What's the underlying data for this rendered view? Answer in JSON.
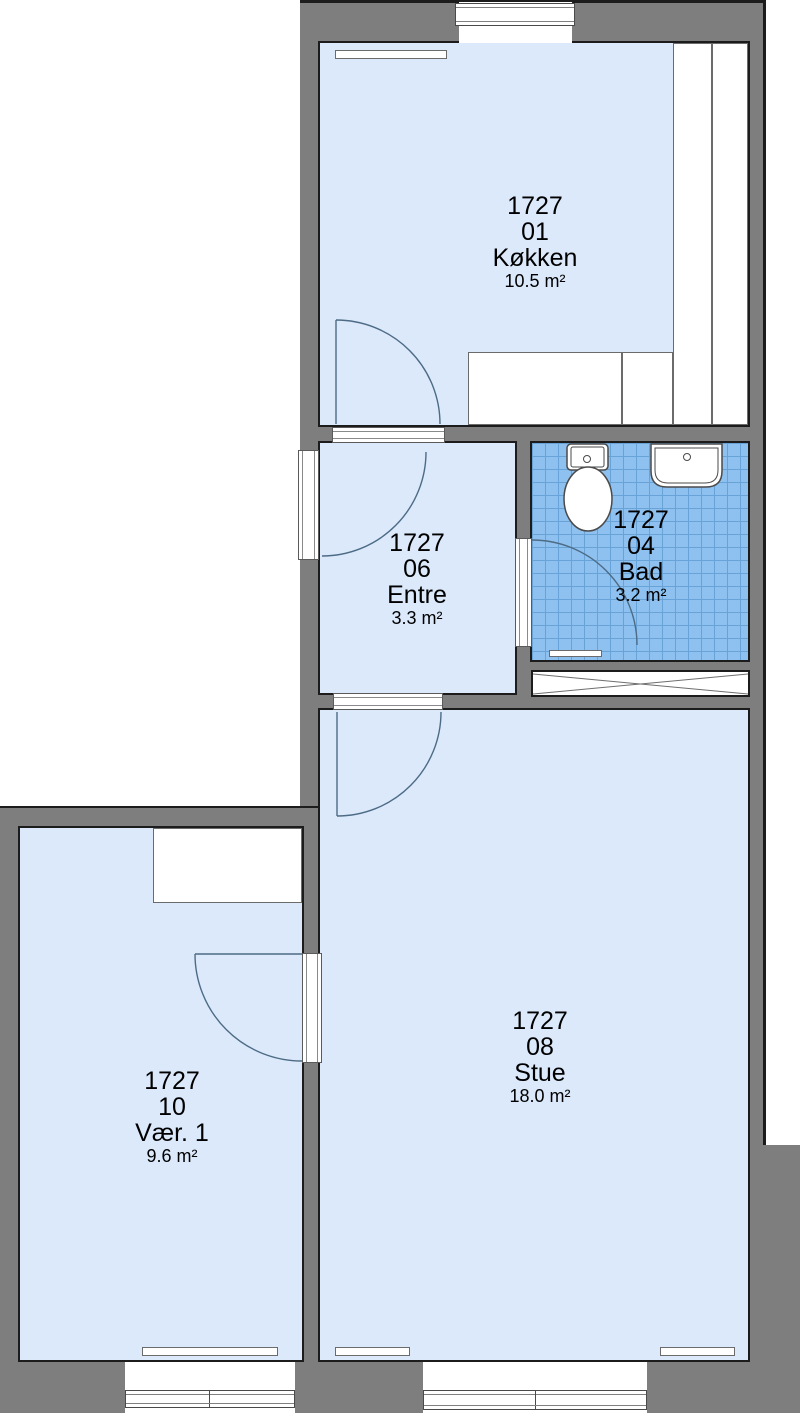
{
  "plan": {
    "title": "Floor plan unit 1727",
    "rooms": [
      {
        "id": "1727",
        "number": "01",
        "name": "Køkken",
        "area": "10.5 m²"
      },
      {
        "id": "1727",
        "number": "06",
        "name": "Entre",
        "area": "3.3 m²"
      },
      {
        "id": "1727",
        "number": "04",
        "name": "Bad",
        "area": "3.2 m²"
      },
      {
        "id": "1727",
        "number": "08",
        "name": "Stue",
        "area": "18.0 m²"
      },
      {
        "id": "1727",
        "number": "10",
        "name": "Vær. 1",
        "area": "9.6 m²"
      }
    ],
    "fixtures": [
      "toilet-icon",
      "sink-icon",
      "kitchen-counter",
      "wardrobe",
      "radiator",
      "ventilation-shaft",
      "window",
      "door-swing",
      "bath-mat"
    ],
    "colors": {
      "wall_gray": "#7e7e7e",
      "floor_blue": "#dbe9fb",
      "tile_blue": "#8ec1f0",
      "tile_grid": "#68a3d8",
      "outline": "#1c1c1c",
      "door_arc": "#4d6b85"
    }
  }
}
